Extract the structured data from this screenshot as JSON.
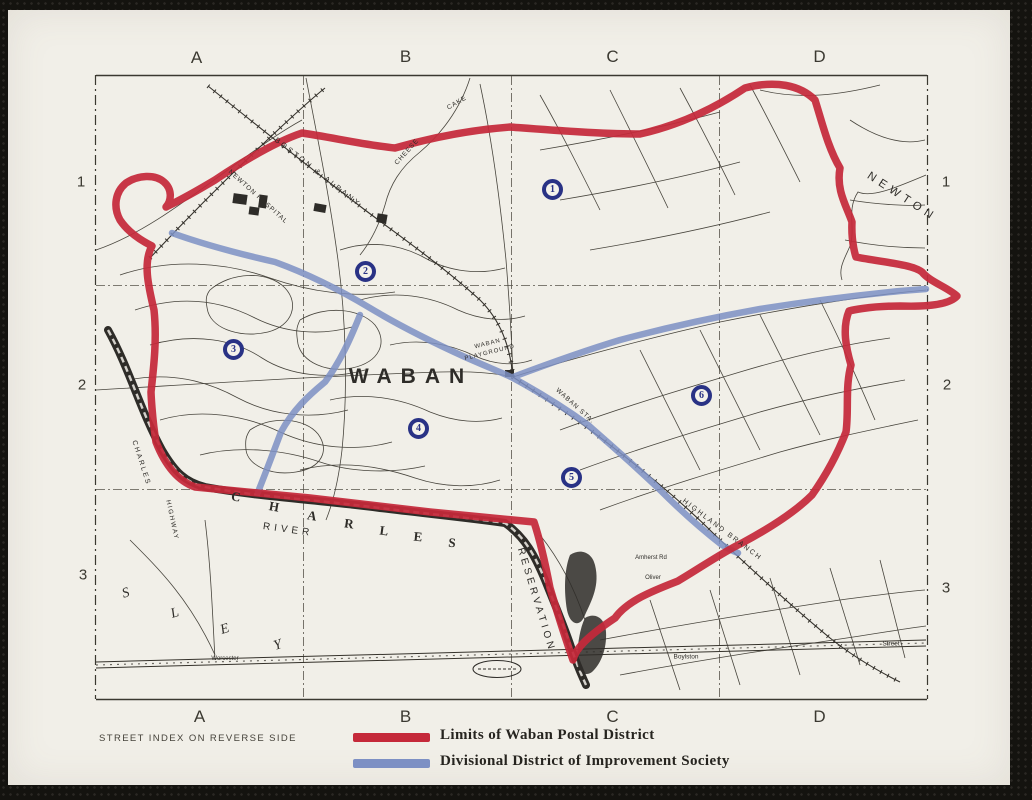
{
  "colors": {
    "paper": "#f1efe8",
    "ink": "#2e2c28",
    "postal_red": "#c5293a",
    "improvement_blue": "#7d90c4",
    "marker_navy": "#293285"
  },
  "grid": {
    "columns_top": [
      "A",
      "B",
      "C",
      "D"
    ],
    "columns_bottom": [
      "A",
      "B",
      "C",
      "D"
    ],
    "rows_left": [
      "1",
      "2",
      "3"
    ],
    "rows_right": [
      "1",
      "2",
      "3"
    ]
  },
  "map": {
    "labels": {
      "waban": "WABAN",
      "newton": "NEWTON",
      "newton_hospital": "NEWTON HOSPITAL",
      "boston_albany": "BOSTON & ALBANY",
      "highland_branch": "HIGHLAND BRANCH",
      "cheese": "CHEESE",
      "cake": "CAKE",
      "waban_playground": "WABAN PLAYGROUND",
      "waban_sta": "WABAN STA.",
      "reservation": "RESERVATION",
      "river": "RIVER",
      "charles_road": "CHARLES",
      "highway": "HIGHWAY",
      "worcester": "Worcester",
      "boylston": "Boylston",
      "street": "Street",
      "amherst": "Amherst Rd",
      "oliver": "Oliver"
    },
    "river_letters": [
      "C",
      "H",
      "A",
      "R",
      "L",
      "E",
      "S"
    ],
    "wellesley_letters": [
      "S",
      "L",
      "E",
      "Y"
    ],
    "markers": [
      "1",
      "2",
      "3",
      "4",
      "5",
      "6"
    ]
  },
  "footer": {
    "note": "STREET INDEX ON REVERSE SIDE",
    "legend": [
      {
        "swatch": "red",
        "label": "Limits of Waban Postal District"
      },
      {
        "swatch": "blue",
        "label": "Divisional District of Improvement Society"
      }
    ]
  }
}
